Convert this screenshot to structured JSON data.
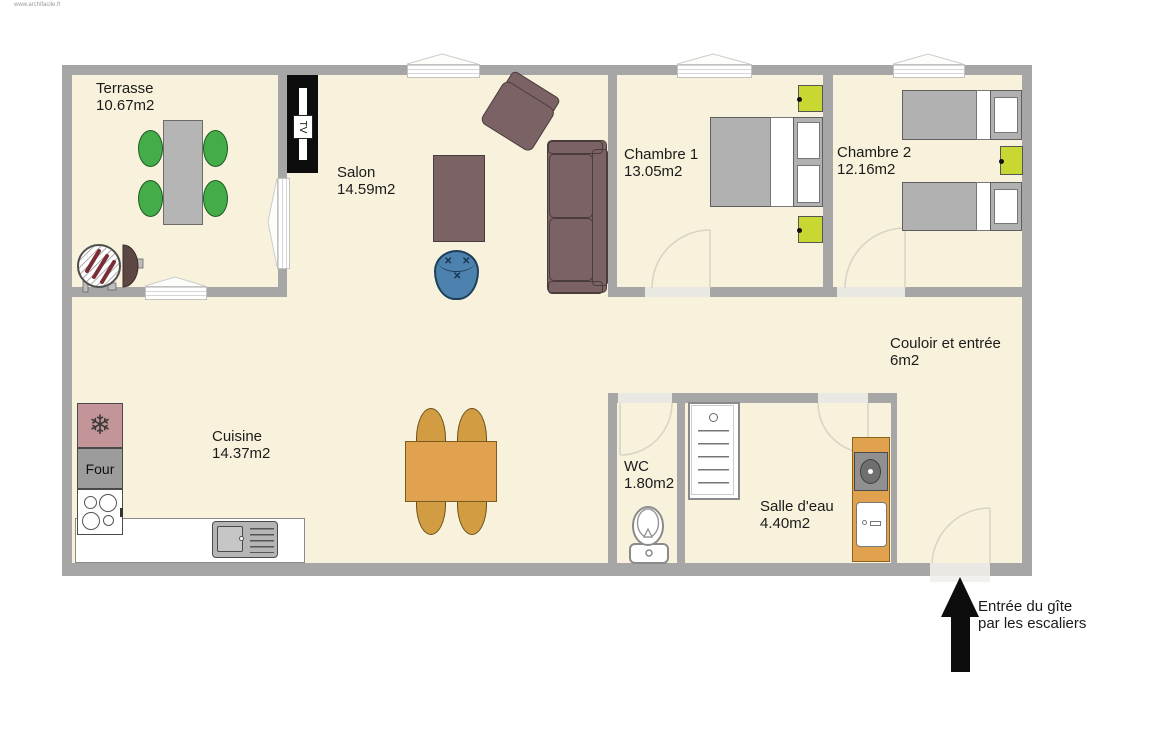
{
  "watermark": "www.archifacile.fr",
  "plan": {
    "rooms": {
      "terrasse": {
        "name": "Terrasse",
        "area": "10.67m2"
      },
      "salon": {
        "name": "Salon",
        "area": "14.59m2"
      },
      "chambre1": {
        "name": "Chambre 1",
        "area": "13.05m2"
      },
      "chambre2": {
        "name": "Chambre 2",
        "area": "12.16m2"
      },
      "couloir": {
        "name": "Couloir et entrée",
        "area": "6m2"
      },
      "cuisine": {
        "name": "Cuisine",
        "area": "14.37m2"
      },
      "wc": {
        "name": "WC",
        "area": "1.80m2"
      },
      "salle_deau": {
        "name": "Salle d'eau",
        "area": "4.40m2"
      }
    },
    "labels": {
      "oven": "Four",
      "tv": "TV"
    },
    "entrance_note": {
      "line1": "Entrée du gîte",
      "line2": "par les escaliers"
    },
    "icons": {
      "freezer": "❄",
      "stitch": "✕"
    },
    "furniture": [
      "terrace dining table with 4 green chairs",
      "barbecue with lid",
      "tv cabinet",
      "sofa",
      "armchair",
      "coffee table",
      "blue pouf",
      "double bed with 2 nightstands",
      "two single beds with nightstand",
      "fridge-freezer",
      "oven",
      "cooktop",
      "kitchen counter with sink",
      "kitchen dining table with 4 chairs",
      "toilet",
      "shower",
      "vanity with washbasin and washing machine"
    ],
    "colors": {
      "floor": "#f8f2dc",
      "wall": "#a6a6a6",
      "furniture_taupe": "#7b6264",
      "chair_green": "#44ad4a",
      "nightstand_lime": "#c9d733",
      "kitchen_orange": "#e0a24e",
      "pouf_blue": "#4d81ae",
      "fridge_pink": "#c39599",
      "arrow_black": "#0d0d0d"
    }
  }
}
